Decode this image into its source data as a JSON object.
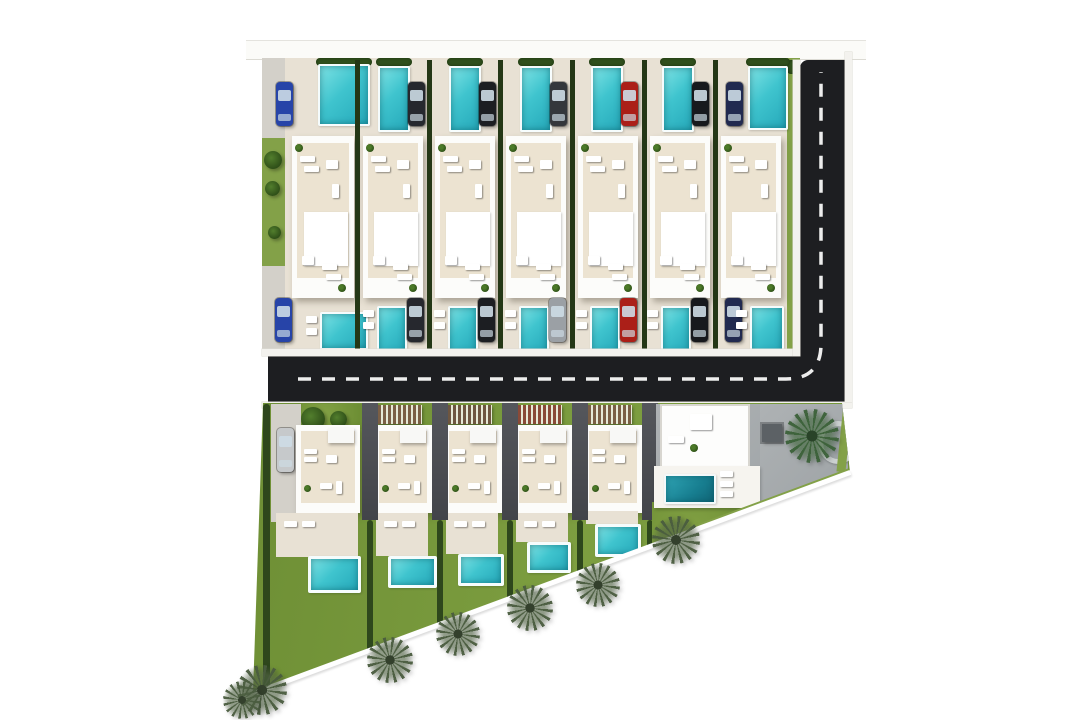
{
  "meta": {
    "description": "Aerial 3D architectural site plan of a residential villa development with private pools, an L-shaped asphalt road and palm trees along a diagonal plot boundary",
    "canvas_w": 1080,
    "canvas_h": 720
  },
  "colors": {
    "background": "#ffffff",
    "road": "#1d1e21",
    "road_marking": "#ededed",
    "paving_light": "#e8e1d4",
    "paving_grey": "#d3d0c9",
    "lawn": "#76973c",
    "grass_strip": "#83a148",
    "hedge_dark": "#2e471c",
    "building_white": "#fcfcfa",
    "roof_terrace": "#ece3d1",
    "pool_turquoise": "#3fc4ce",
    "pool_deep": "#177e90",
    "driveway_dark": "#4a4c51",
    "concrete": "#a8acaf",
    "palm_green": "#4a5c3f"
  },
  "sidewalk": {
    "x": 246,
    "y": 40,
    "w": 620,
    "h": 18
  },
  "top_block": {
    "base": {
      "x": 262,
      "y": 58,
      "w": 537,
      "h": 298
    },
    "left_strip": {
      "x": 262,
      "y": 58,
      "w": 23,
      "h": 298,
      "green_y": 138,
      "green_h": 128
    },
    "left_trees": [
      [
        273,
        160,
        18
      ],
      [
        272,
        188,
        15
      ],
      [
        274,
        232,
        13
      ]
    ],
    "right_strip": {
      "x": 787,
      "y": 58,
      "w": 13,
      "h": 298
    },
    "gap_xs": [
      357,
      429,
      500,
      572,
      644,
      715
    ],
    "gap_y": 60,
    "gap_h": 294,
    "villas": [
      {
        "id": "top-villa-1",
        "building": {
          "x": 292,
          "y": 136,
          "w": 62,
          "h": 162
        },
        "pool_top": {
          "x": 318,
          "y": 64,
          "w": 48,
          "h": 58
        },
        "car_top": {
          "x": 276,
          "y": 82,
          "color": "#2744a8"
        },
        "pool_bottom": {
          "x": 320,
          "y": 312,
          "w": 44,
          "h": 34
        },
        "car_bottom": {
          "x": 275,
          "y": 298,
          "color": "#2744a8"
        }
      },
      {
        "id": "top-villa-2",
        "building": {
          "x": 363,
          "y": 136,
          "w": 60,
          "h": 162
        },
        "pool_top": {
          "x": 378,
          "y": 66,
          "w": 28,
          "h": 62
        },
        "car_top": {
          "x": 408,
          "y": 82,
          "color": "#26282e"
        },
        "pool_bottom": {
          "x": 377,
          "y": 306,
          "w": 26,
          "h": 44
        },
        "car_bottom": {
          "x": 407,
          "y": 298,
          "color": "#26282e"
        }
      },
      {
        "id": "top-villa-3",
        "building": {
          "x": 435,
          "y": 136,
          "w": 60,
          "h": 162
        },
        "pool_top": {
          "x": 449,
          "y": 66,
          "w": 28,
          "h": 62
        },
        "car_top": {
          "x": 479,
          "y": 82,
          "color": "#1c1e22"
        },
        "pool_bottom": {
          "x": 448,
          "y": 306,
          "w": 26,
          "h": 44
        },
        "car_bottom": {
          "x": 478,
          "y": 298,
          "color": "#1c1e22"
        }
      },
      {
        "id": "top-villa-4",
        "building": {
          "x": 506,
          "y": 136,
          "w": 60,
          "h": 162
        },
        "pool_top": {
          "x": 520,
          "y": 66,
          "w": 28,
          "h": 62
        },
        "car_top": {
          "x": 550,
          "y": 82,
          "color": "#34373c"
        },
        "pool_bottom": {
          "x": 519,
          "y": 306,
          "w": 26,
          "h": 44
        },
        "car_bottom": {
          "x": 549,
          "y": 298,
          "color": "#9ba0a5"
        }
      },
      {
        "id": "top-villa-5",
        "building": {
          "x": 578,
          "y": 136,
          "w": 60,
          "h": 162
        },
        "pool_top": {
          "x": 591,
          "y": 66,
          "w": 28,
          "h": 62
        },
        "car_top": {
          "x": 621,
          "y": 82,
          "color": "#ab1f18"
        },
        "pool_bottom": {
          "x": 590,
          "y": 306,
          "w": 26,
          "h": 44
        },
        "car_bottom": {
          "x": 620,
          "y": 298,
          "color": "#ab1f18"
        }
      },
      {
        "id": "top-villa-6",
        "building": {
          "x": 650,
          "y": 136,
          "w": 60,
          "h": 162
        },
        "pool_top": {
          "x": 662,
          "y": 66,
          "w": 28,
          "h": 62
        },
        "car_top": {
          "x": 692,
          "y": 82,
          "color": "#17191d"
        },
        "pool_bottom": {
          "x": 661,
          "y": 306,
          "w": 26,
          "h": 44
        },
        "car_bottom": {
          "x": 691,
          "y": 298,
          "color": "#17191d"
        }
      },
      {
        "id": "top-villa-7",
        "building": {
          "x": 721,
          "y": 136,
          "w": 60,
          "h": 162
        },
        "pool_top": {
          "x": 748,
          "y": 66,
          "w": 36,
          "h": 60
        },
        "car_top": {
          "x": 726,
          "y": 82,
          "color": "#212a50"
        },
        "pool_bottom": {
          "x": 750,
          "y": 306,
          "w": 30,
          "h": 44
        },
        "car_bottom": {
          "x": 725,
          "y": 298,
          "color": "#212a50"
        }
      }
    ]
  },
  "road": {
    "horizontal": {
      "x": 268,
      "y": 356,
      "w": 577,
      "h": 46
    },
    "vertical": {
      "x": 800,
      "y": 60,
      "w": 45,
      "h": 342
    },
    "curbs": [
      {
        "x": 262,
        "y": 349,
        "w": 532,
        "h": 7
      },
      {
        "x": 262,
        "y": 402,
        "w": 590,
        "h": 6
      },
      {
        "x": 793,
        "y": 60,
        "w": 7,
        "h": 296
      },
      {
        "x": 845,
        "y": 52,
        "w": 7,
        "h": 350
      }
    ],
    "centerline": {
      "hx1": 298,
      "hx2": 786,
      "hy": 379,
      "vx": 821,
      "vy1": 72,
      "r": 35
    },
    "dash": "13 11",
    "dash_width": 3.5
  },
  "bottom_block": {
    "clip": [
      [
        263,
        403
      ],
      [
        842,
        403
      ],
      [
        850,
        472
      ],
      [
        253,
        693
      ]
    ],
    "lawn": {
      "x": 253,
      "y": 403,
      "w": 600,
      "h": 292
    },
    "left_hedge": {
      "x": 263,
      "y": 404,
      "w": 7,
      "h": 285
    },
    "driveway_xs": [
      362,
      432,
      502,
      572,
      642
    ],
    "driveway": {
      "y": 402,
      "w": 16,
      "h": 118
    },
    "hedge_xs": [
      370,
      440,
      510,
      580,
      650
    ],
    "villas": [
      {
        "id": "bottom-villa-1",
        "paving": {
          "x": 271,
          "y": 404,
          "w": 30,
          "h": 118
        },
        "car": {
          "x": 277,
          "y": 428,
          "color": "#c6c9cb"
        },
        "lawn_patch": {
          "x": 302,
          "y": 404,
          "w": 64,
          "h": 25
        },
        "trees": [
          [
            313,
            407,
            24
          ],
          [
            338,
            411,
            17
          ]
        ],
        "building": {
          "x": 296,
          "y": 425,
          "w": 64,
          "h": 88
        },
        "terrace": {
          "x": 276,
          "y": 513,
          "w": 82,
          "h": 44
        },
        "pool": {
          "x": 308,
          "y": 556,
          "w": 47,
          "h": 31
        }
      },
      {
        "id": "bottom-villa-2",
        "pergola": {
          "x": 378,
          "y": 405,
          "w": 44,
          "h": 19,
          "color": "#7b5f45"
        },
        "building": {
          "x": 374,
          "y": 425,
          "w": 58,
          "h": 88
        },
        "terrace": {
          "x": 376,
          "y": 513,
          "w": 52,
          "h": 43
        },
        "pool": {
          "x": 388,
          "y": 556,
          "w": 43,
          "h": 26
        }
      },
      {
        "id": "bottom-villa-3",
        "pergola": {
          "x": 448,
          "y": 405,
          "w": 44,
          "h": 19,
          "color": "#6e5640"
        },
        "building": {
          "x": 444,
          "y": 425,
          "w": 58,
          "h": 88
        },
        "terrace": {
          "x": 446,
          "y": 513,
          "w": 52,
          "h": 41
        },
        "pool": {
          "x": 458,
          "y": 554,
          "w": 40,
          "h": 26
        }
      },
      {
        "id": "bottom-villa-4",
        "pergola": {
          "x": 518,
          "y": 405,
          "w": 44,
          "h": 19,
          "color": "#8a4a38"
        },
        "building": {
          "x": 514,
          "y": 425,
          "w": 58,
          "h": 88
        },
        "terrace": {
          "x": 516,
          "y": 513,
          "w": 52,
          "h": 29
        },
        "pool": {
          "x": 527,
          "y": 542,
          "w": 38,
          "h": 25
        }
      },
      {
        "id": "bottom-villa-5",
        "pergola": {
          "x": 588,
          "y": 405,
          "w": 44,
          "h": 19,
          "color": "#7b5f45"
        },
        "building": {
          "x": 584,
          "y": 425,
          "w": 58,
          "h": 88
        },
        "terrace": {
          "x": 586,
          "y": 511,
          "w": 52,
          "h": 13
        },
        "pool": {
          "x": 595,
          "y": 524,
          "w": 40,
          "h": 27
        }
      }
    ],
    "corner_plot": {
      "concrete": [
        {
          "x": 656,
          "y": 404,
          "w": 192,
          "h": 78
        },
        {
          "x": 760,
          "y": 404,
          "w": 88,
          "h": 110
        }
      ],
      "interior": {
        "x": 660,
        "y": 404,
        "w": 86,
        "h": 60
      },
      "dining": {
        "x": 688,
        "y": 412,
        "w": 22,
        "h": 16
      },
      "out_table": {
        "x": 762,
        "y": 424,
        "w": 20,
        "h": 18
      },
      "deck": {
        "x": 654,
        "y": 466,
        "w": 106,
        "h": 42
      },
      "pool": {
        "x": 664,
        "y": 474,
        "w": 48,
        "h": 26
      },
      "loungers": [
        [
          720,
          471
        ],
        [
          720,
          481
        ],
        [
          720,
          491
        ]
      ],
      "palm": [
        812,
        436,
        54
      ],
      "ring": {
        "x": 818,
        "y": 421,
        "w": 30,
        "h": 33
      },
      "right_olive": {
        "x": 840,
        "y": 404,
        "w": 9,
        "h": 68
      },
      "diag_olive": {
        "x": 688,
        "y": 528,
        "len": 172,
        "h": 8
      },
      "lawn_patch": {
        "x": 652,
        "y": 502,
        "w": 112,
        "h": 90
      }
    }
  },
  "diagonal": {
    "x1": 253,
    "y1": 693,
    "x2": 850,
    "y2": 472
  },
  "palms": [
    [
      262,
      690,
      50
    ],
    [
      242,
      700,
      38
    ],
    [
      390,
      660,
      46
    ],
    [
      458,
      634,
      44
    ],
    [
      530,
      608,
      46
    ],
    [
      598,
      585,
      44
    ],
    [
      676,
      540,
      48
    ]
  ]
}
